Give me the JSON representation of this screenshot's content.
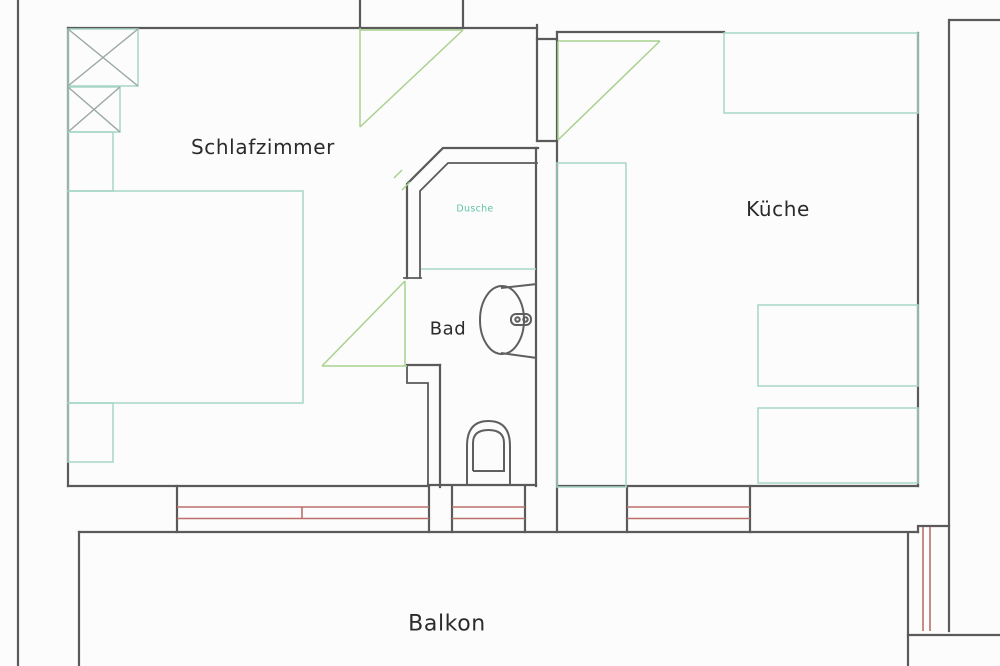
{
  "title": "apartment-floor-plan",
  "rooms": {
    "bedroom": {
      "label": "Schlafzimmer"
    },
    "kitchen": {
      "label": "Küche"
    },
    "bathroom": {
      "label": "Bad"
    },
    "shower": {
      "label": "Dusche"
    },
    "balcony": {
      "label": "Balkon"
    }
  },
  "colors": {
    "wall": "#5a5a5a",
    "furniture": "#a6d6c3",
    "door": "#a9d18e",
    "window": "#bb6f68",
    "shower_text": "#5fc3a8",
    "label": "#2b2b2b",
    "background": "#fcfcfc"
  }
}
